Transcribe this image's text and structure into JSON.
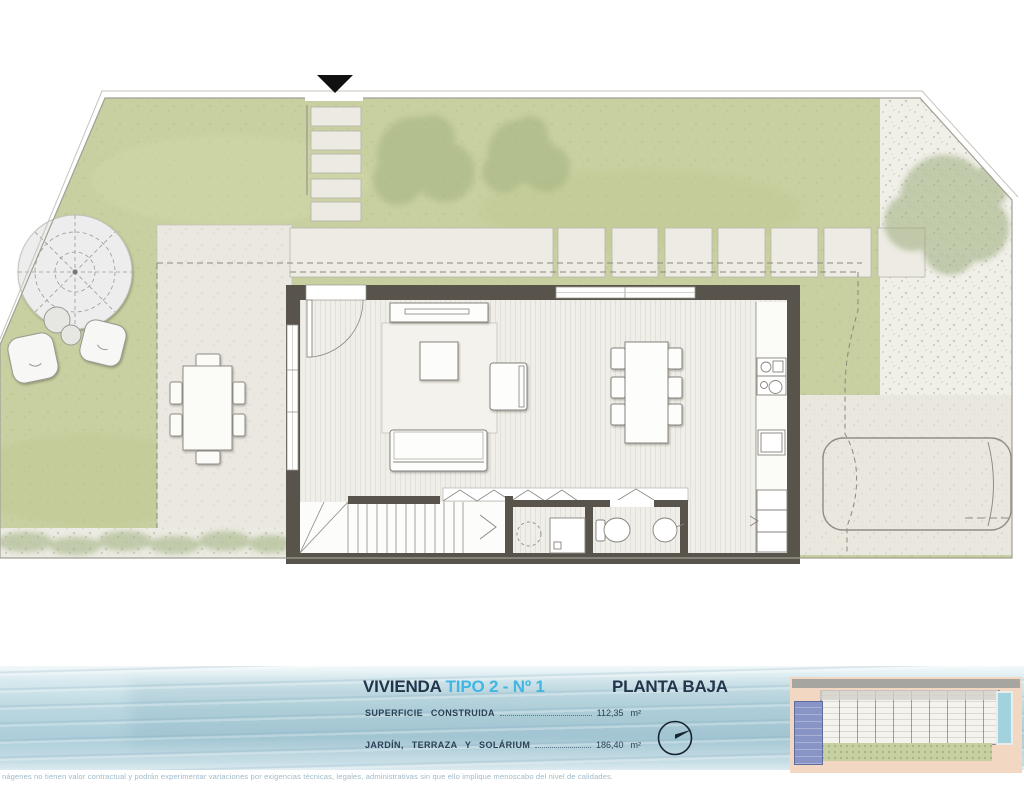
{
  "title_block": {
    "unit_label": "VIVIENDA",
    "unit_type": "TIPO 2 - Nº 1",
    "floor_label": "PLANTA BAJA",
    "areas": [
      {
        "label": "SUPERFICIE CONSTRUIDA",
        "value": "112,35",
        "unit": "m²"
      },
      {
        "label": "JARDÍN, TERRAZA Y SOLÁRIUM",
        "value": "186,40",
        "unit": "m²"
      }
    ]
  },
  "disclaimer": "nágenes no tienen valor contractual y podrán experimentar variaciones por exigencias técnicas, legales, administrativas sin que ello implique menoscabo del nivel de calidades.",
  "colors": {
    "accent_cyan": "#41b6e3",
    "title_dark": "#22354a",
    "lawn_green": "#c8cfa0",
    "house_wall": "#59544b",
    "water_band_blue": "#bcd8e2",
    "keyplan_background": "#f2d7c2",
    "keyplan_highlight_unit": "#8894c5"
  },
  "icons": {
    "north_indicator": "circle-with-needle",
    "entrance_marker": "black-down-triangle"
  }
}
